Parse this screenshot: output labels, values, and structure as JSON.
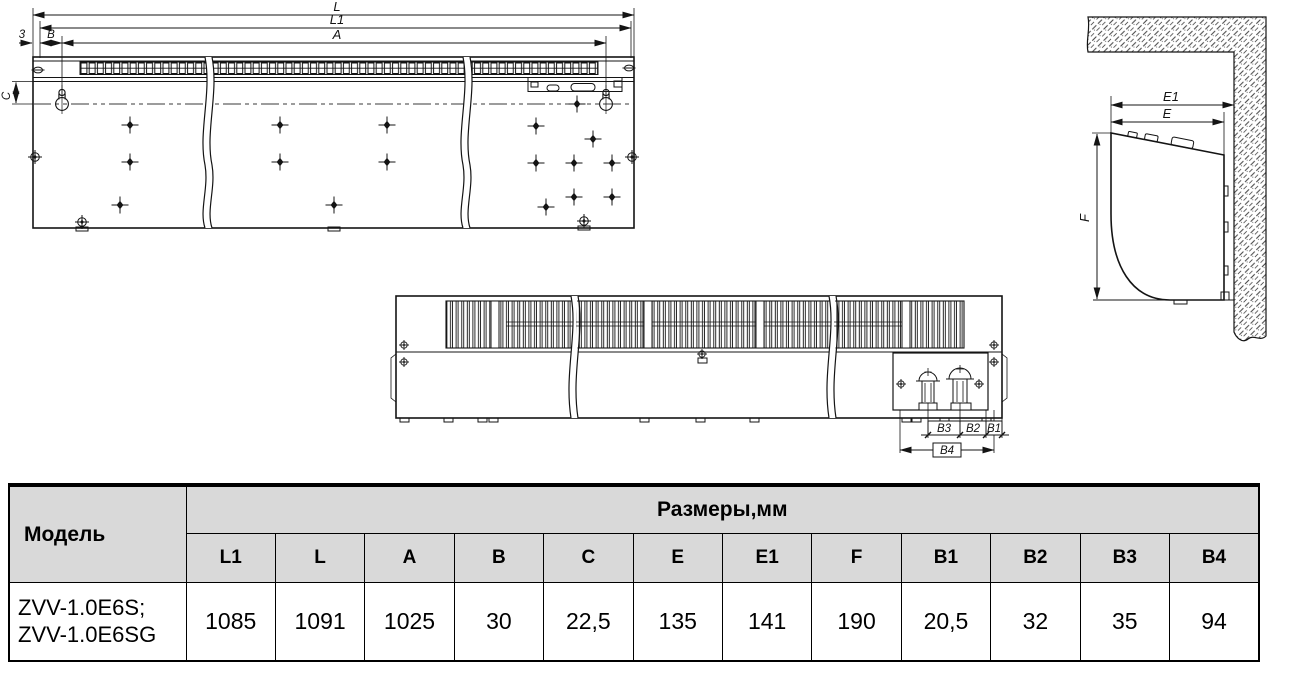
{
  "document": {
    "kind": "air-curtain dimensional drawing datasheet"
  },
  "drawings": {
    "front_view": {
      "labels": {
        "L": "L",
        "L1": "L1",
        "A": "A",
        "B": "B",
        "three": "3",
        "C": "C"
      }
    },
    "bottom_view": {
      "labels": {
        "B1": "B1",
        "B2": "B2",
        "B3": "B3",
        "B4": "B4"
      }
    },
    "side_view": {
      "labels": {
        "E": "E",
        "E1": "E1",
        "F": "F"
      }
    }
  },
  "table": {
    "model_header": "Модель",
    "dimensions_header": "Размеры,мм",
    "columns": [
      "L1",
      "L",
      "A",
      "B",
      "C",
      "E",
      "E1",
      "F",
      "B1",
      "B2",
      "B3",
      "B4"
    ],
    "rows": [
      {
        "model_lines": [
          "ZVV-1.0E6S;",
          "ZVV-1.0E6SG"
        ],
        "values": [
          "1085",
          "1091",
          "1025",
          "30",
          "22,5",
          "135",
          "141",
          "190",
          "20,5",
          "32",
          "35",
          "94"
        ]
      }
    ]
  },
  "colors": {
    "header_bg": "#d9d9d9",
    "line_color": "#141414",
    "background": "#ffffff"
  }
}
